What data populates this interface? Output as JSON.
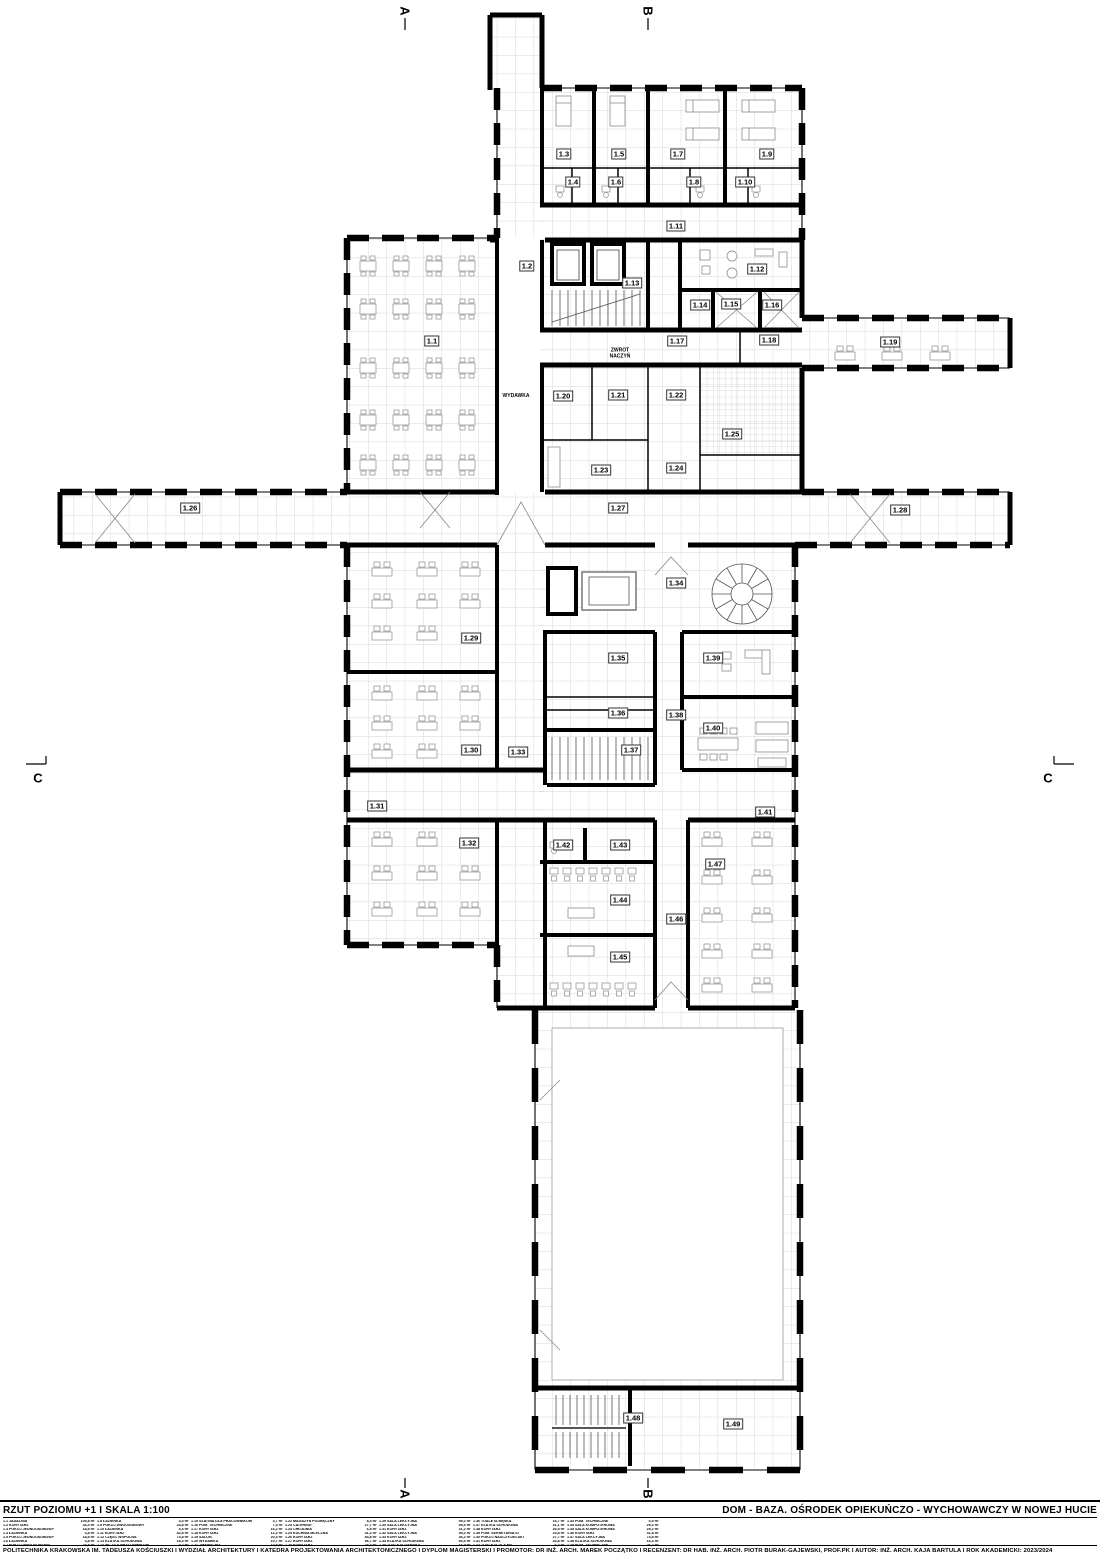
{
  "title_block": {
    "drawing_title": "RZUT POZIOMU +1  I  SKALA 1:100",
    "project_title": "DOM - BAZA. OŚRODEK OPIEKUŃCZO - WYCHOWAWCZY W NOWEJ HUCIE",
    "credits": "POLITECHNIKA KRAKOWSKA IM. TADEUSZA KOŚCIUSZKI  I  WYDZIAŁ ARCHITEKTURY  I  KATEDRA PROJEKTOWANIA ARCHITEKTONICZNEGO  I  DYPLOM MAGISTERSKI  I  PROMOTOR: DR INŻ. ARCH. MAREK POCZĄTKO  I  RECENZENT: DR HAB. INŻ. ARCH. PIOTR BURAK-GAJEWSKI, PROF.PK  I  AUTOR: INŻ. ARCH. KAJA BARTULA  I  ROK AKADEMICKI: 2023/2024"
  },
  "legend": {
    "entries": [
      {
        "no": "1.1",
        "name": "JADALNIA",
        "area": "105,8 m²"
      },
      {
        "no": "1.2",
        "name": "KORYTARZ",
        "area": "34,3 m²"
      },
      {
        "no": "1.3",
        "name": "POKÓJ JEDNOOSOBOWY",
        "area": "18,8 m²"
      },
      {
        "no": "1.4",
        "name": "ŁAZIENKA",
        "area": "3,8 m²"
      },
      {
        "no": "1.5",
        "name": "POKÓJ JEDNOOSOBOWY",
        "area": "18,8 m²"
      },
      {
        "no": "1.6",
        "name": "ŁAZIENKA",
        "area": "3,8 m²"
      },
      {
        "no": "1.7",
        "name": "POKÓJ DWUOSOBOWY",
        "area": "24,8 m²"
      },
      {
        "no": "1.8",
        "name": "ŁAZIENKA",
        "area": "4,4 m²"
      },
      {
        "no": "1.9",
        "name": "POKÓJ DWUOSOBOWY",
        "area": "24,8 m²"
      },
      {
        "no": "1.10",
        "name": "ŁAZIENKA",
        "area": "4,4 m²"
      },
      {
        "no": "1.11",
        "name": "KORYTARZ",
        "area": "42,8 m²"
      },
      {
        "no": "1.12",
        "name": "CZĘŚĆ WSPÓLNA",
        "area": "74,8 m²"
      },
      {
        "no": "1.13",
        "name": "KLATKA SCHODOWA",
        "area": "18,3 m²"
      },
      {
        "no": "1.14",
        "name": "WC DLA PRACOWNIKÓW",
        "area": "5,2 m²"
      },
      {
        "no": "1.15",
        "name": "SZATNIA DLA PRACOWNIKÓW",
        "area": "3,7 m²"
      },
      {
        "no": "1.16",
        "name": "POM. TECHNICZNE",
        "area": "7,4 m²"
      },
      {
        "no": "1.17",
        "name": "KORYTARZ",
        "area": "16,2 m²"
      },
      {
        "no": "1.18",
        "name": "KORYTARZ",
        "area": "12,2 m²"
      },
      {
        "no": "1.19",
        "name": "SALON",
        "area": "20,4 m²"
      },
      {
        "no": "1.20",
        "name": "WYDAWKA",
        "area": "10,7 m²"
      },
      {
        "no": "1.21",
        "name": "ZMYWALNIA",
        "area": "10,8 m²"
      },
      {
        "no": "1.22",
        "name": "MAGAZYN PODRĘCZNY",
        "area": "8,4 m²"
      },
      {
        "no": "1.23",
        "name": "CATERING",
        "area": "27,7 m²"
      },
      {
        "no": "1.24",
        "name": "CHŁODNIA",
        "area": "6,8 m²"
      },
      {
        "no": "1.25",
        "name": "KUCHNIA MLECZNA",
        "area": "31,2 m²"
      },
      {
        "no": "1.26",
        "name": "KORYTARZ",
        "area": "83,8 m²"
      },
      {
        "no": "1.27",
        "name": "KORYTARZ",
        "area": "96,7 m²"
      },
      {
        "no": "1.28",
        "name": "KORYTARZ",
        "area": "28,4 m²"
      },
      {
        "no": "1.29",
        "name": "SALA LEKCYJNA",
        "area": "59,2 m²"
      },
      {
        "no": "1.30",
        "name": "SALA LEKCYJNA",
        "area": "59,4 m²"
      },
      {
        "no": "1.31",
        "name": "KORYTARZ",
        "area": "31,2 m²"
      },
      {
        "no": "1.32",
        "name": "SALA LEKCYJNA",
        "area": "59,2 m²"
      },
      {
        "no": "1.33",
        "name": "KORYTARZ",
        "area": "36,2 m²"
      },
      {
        "no": "1.34",
        "name": "KLATKA SCHODOWA",
        "area": "50,4 m²"
      },
      {
        "no": "1.35",
        "name": "TOALETA DAMSKA",
        "area": "16,9 m²"
      },
      {
        "no": "1.36",
        "name": "TOALETA MĘSKA",
        "area": "16,7 m²"
      },
      {
        "no": "1.37",
        "name": "KLATKA SCHODOWA",
        "area": "31,1 m²"
      },
      {
        "no": "1.38",
        "name": "KORYTARZ",
        "area": "26,9 m²"
      },
      {
        "no": "1.39",
        "name": "POM. SEKRETARIATU",
        "area": "23,8 m²"
      },
      {
        "no": "1.40",
        "name": "POKÓJ NAUCZYCIELSKI",
        "area": "27,7 m²"
      },
      {
        "no": "1.41",
        "name": "KORYTARZ",
        "area": "43,8 m²"
      },
      {
        "no": "1.42",
        "name": "TOALETA DLA NP",
        "area": "6,3 m²"
      },
      {
        "no": "1.43",
        "name": "POM. TECHNICZNE",
        "area": "6,5 m²"
      },
      {
        "no": "1.44",
        "name": "SALA KOMPUTEROWA",
        "area": "29,2 m²"
      },
      {
        "no": "1.45",
        "name": "SALA KOMPUTEROWA",
        "area": "29,2 m²"
      },
      {
        "no": "1.46",
        "name": "KORYTARZ",
        "area": "31,8 m²"
      },
      {
        "no": "1.47",
        "name": "SALA LEKCYJNA",
        "area": "74,8 m²"
      },
      {
        "no": "1.48",
        "name": "KLATKA SCHODOWA",
        "area": "16,4 m²"
      },
      {
        "no": "1.49",
        "name": "POM. TECHNICZNE",
        "area": "26,2 m²"
      }
    ]
  },
  "plan": {
    "labels": [
      {
        "id": "1.1",
        "x": 432,
        "y": 341
      },
      {
        "id": "1.2",
        "x": 527,
        "y": 266
      },
      {
        "id": "1.3",
        "x": 564,
        "y": 154
      },
      {
        "id": "1.4",
        "x": 573,
        "y": 182
      },
      {
        "id": "1.5",
        "x": 619,
        "y": 154
      },
      {
        "id": "1.6",
        "x": 616,
        "y": 182
      },
      {
        "id": "1.7",
        "x": 678,
        "y": 154
      },
      {
        "id": "1.8",
        "x": 694,
        "y": 182
      },
      {
        "id": "1.9",
        "x": 767,
        "y": 154
      },
      {
        "id": "1.10",
        "x": 745,
        "y": 182
      },
      {
        "id": "1.11",
        "x": 676,
        "y": 226
      },
      {
        "id": "1.12",
        "x": 757,
        "y": 269
      },
      {
        "id": "1.13",
        "x": 632,
        "y": 283
      },
      {
        "id": "1.14",
        "x": 700,
        "y": 305
      },
      {
        "id": "1.15",
        "x": 731,
        "y": 304
      },
      {
        "id": "1.16",
        "x": 772,
        "y": 305
      },
      {
        "id": "1.17",
        "x": 677,
        "y": 341
      },
      {
        "id": "1.18",
        "x": 769,
        "y": 340
      },
      {
        "id": "1.19",
        "x": 890,
        "y": 342
      },
      {
        "id": "1.20",
        "x": 563,
        "y": 396
      },
      {
        "id": "1.21",
        "x": 618,
        "y": 395
      },
      {
        "id": "1.22",
        "x": 676,
        "y": 395
      },
      {
        "id": "1.23",
        "x": 601,
        "y": 470
      },
      {
        "id": "1.24",
        "x": 676,
        "y": 468
      },
      {
        "id": "1.25",
        "x": 732,
        "y": 434
      },
      {
        "id": "1.26",
        "x": 190,
        "y": 508
      },
      {
        "id": "1.27",
        "x": 618,
        "y": 508
      },
      {
        "id": "1.28",
        "x": 900,
        "y": 510
      },
      {
        "id": "1.29",
        "x": 471,
        "y": 638
      },
      {
        "id": "1.30",
        "x": 471,
        "y": 750
      },
      {
        "id": "1.31",
        "x": 377,
        "y": 806
      },
      {
        "id": "1.32",
        "x": 469,
        "y": 843
      },
      {
        "id": "1.33",
        "x": 518,
        "y": 752
      },
      {
        "id": "1.34",
        "x": 676,
        "y": 583
      },
      {
        "id": "1.35",
        "x": 618,
        "y": 658
      },
      {
        "id": "1.36",
        "x": 618,
        "y": 713
      },
      {
        "id": "1.37",
        "x": 631,
        "y": 750
      },
      {
        "id": "1.38",
        "x": 676,
        "y": 715
      },
      {
        "id": "1.39",
        "x": 713,
        "y": 658
      },
      {
        "id": "1.40",
        "x": 713,
        "y": 728
      },
      {
        "id": "1.41",
        "x": 765,
        "y": 812
      },
      {
        "id": "1.42",
        "x": 563,
        "y": 845
      },
      {
        "id": "1.43",
        "x": 620,
        "y": 845
      },
      {
        "id": "1.44",
        "x": 620,
        "y": 900
      },
      {
        "id": "1.45",
        "x": 620,
        "y": 957
      },
      {
        "id": "1.46",
        "x": 676,
        "y": 919
      },
      {
        "id": "1.47",
        "x": 715,
        "y": 864
      },
      {
        "id": "1.48",
        "x": 633,
        "y": 1418
      },
      {
        "id": "1.49",
        "x": 733,
        "y": 1424
      }
    ],
    "annotations": [
      {
        "text": "ZWROT\nNACZYŃ",
        "x": 620,
        "y": 354
      },
      {
        "text": "WYDAWKA",
        "x": 516,
        "y": 397
      }
    ],
    "section_markers": [
      {
        "label": "A",
        "x": 405,
        "y": 11,
        "edge": "top"
      },
      {
        "label": "B",
        "x": 648,
        "y": 11,
        "edge": "top"
      },
      {
        "label": "A",
        "x": 405,
        "y": 1494,
        "edge": "bottom"
      },
      {
        "label": "B",
        "x": 648,
        "y": 1494,
        "edge": "bottom"
      },
      {
        "label": "C",
        "x": 38,
        "y": 778,
        "edge": "left"
      },
      {
        "label": "C",
        "x": 1048,
        "y": 778,
        "edge": "right"
      }
    ]
  },
  "colors": {
    "wall": "#000000",
    "grid": "#c9c9c9",
    "furniture": "#9a9a9a",
    "background": "#ffffff"
  }
}
